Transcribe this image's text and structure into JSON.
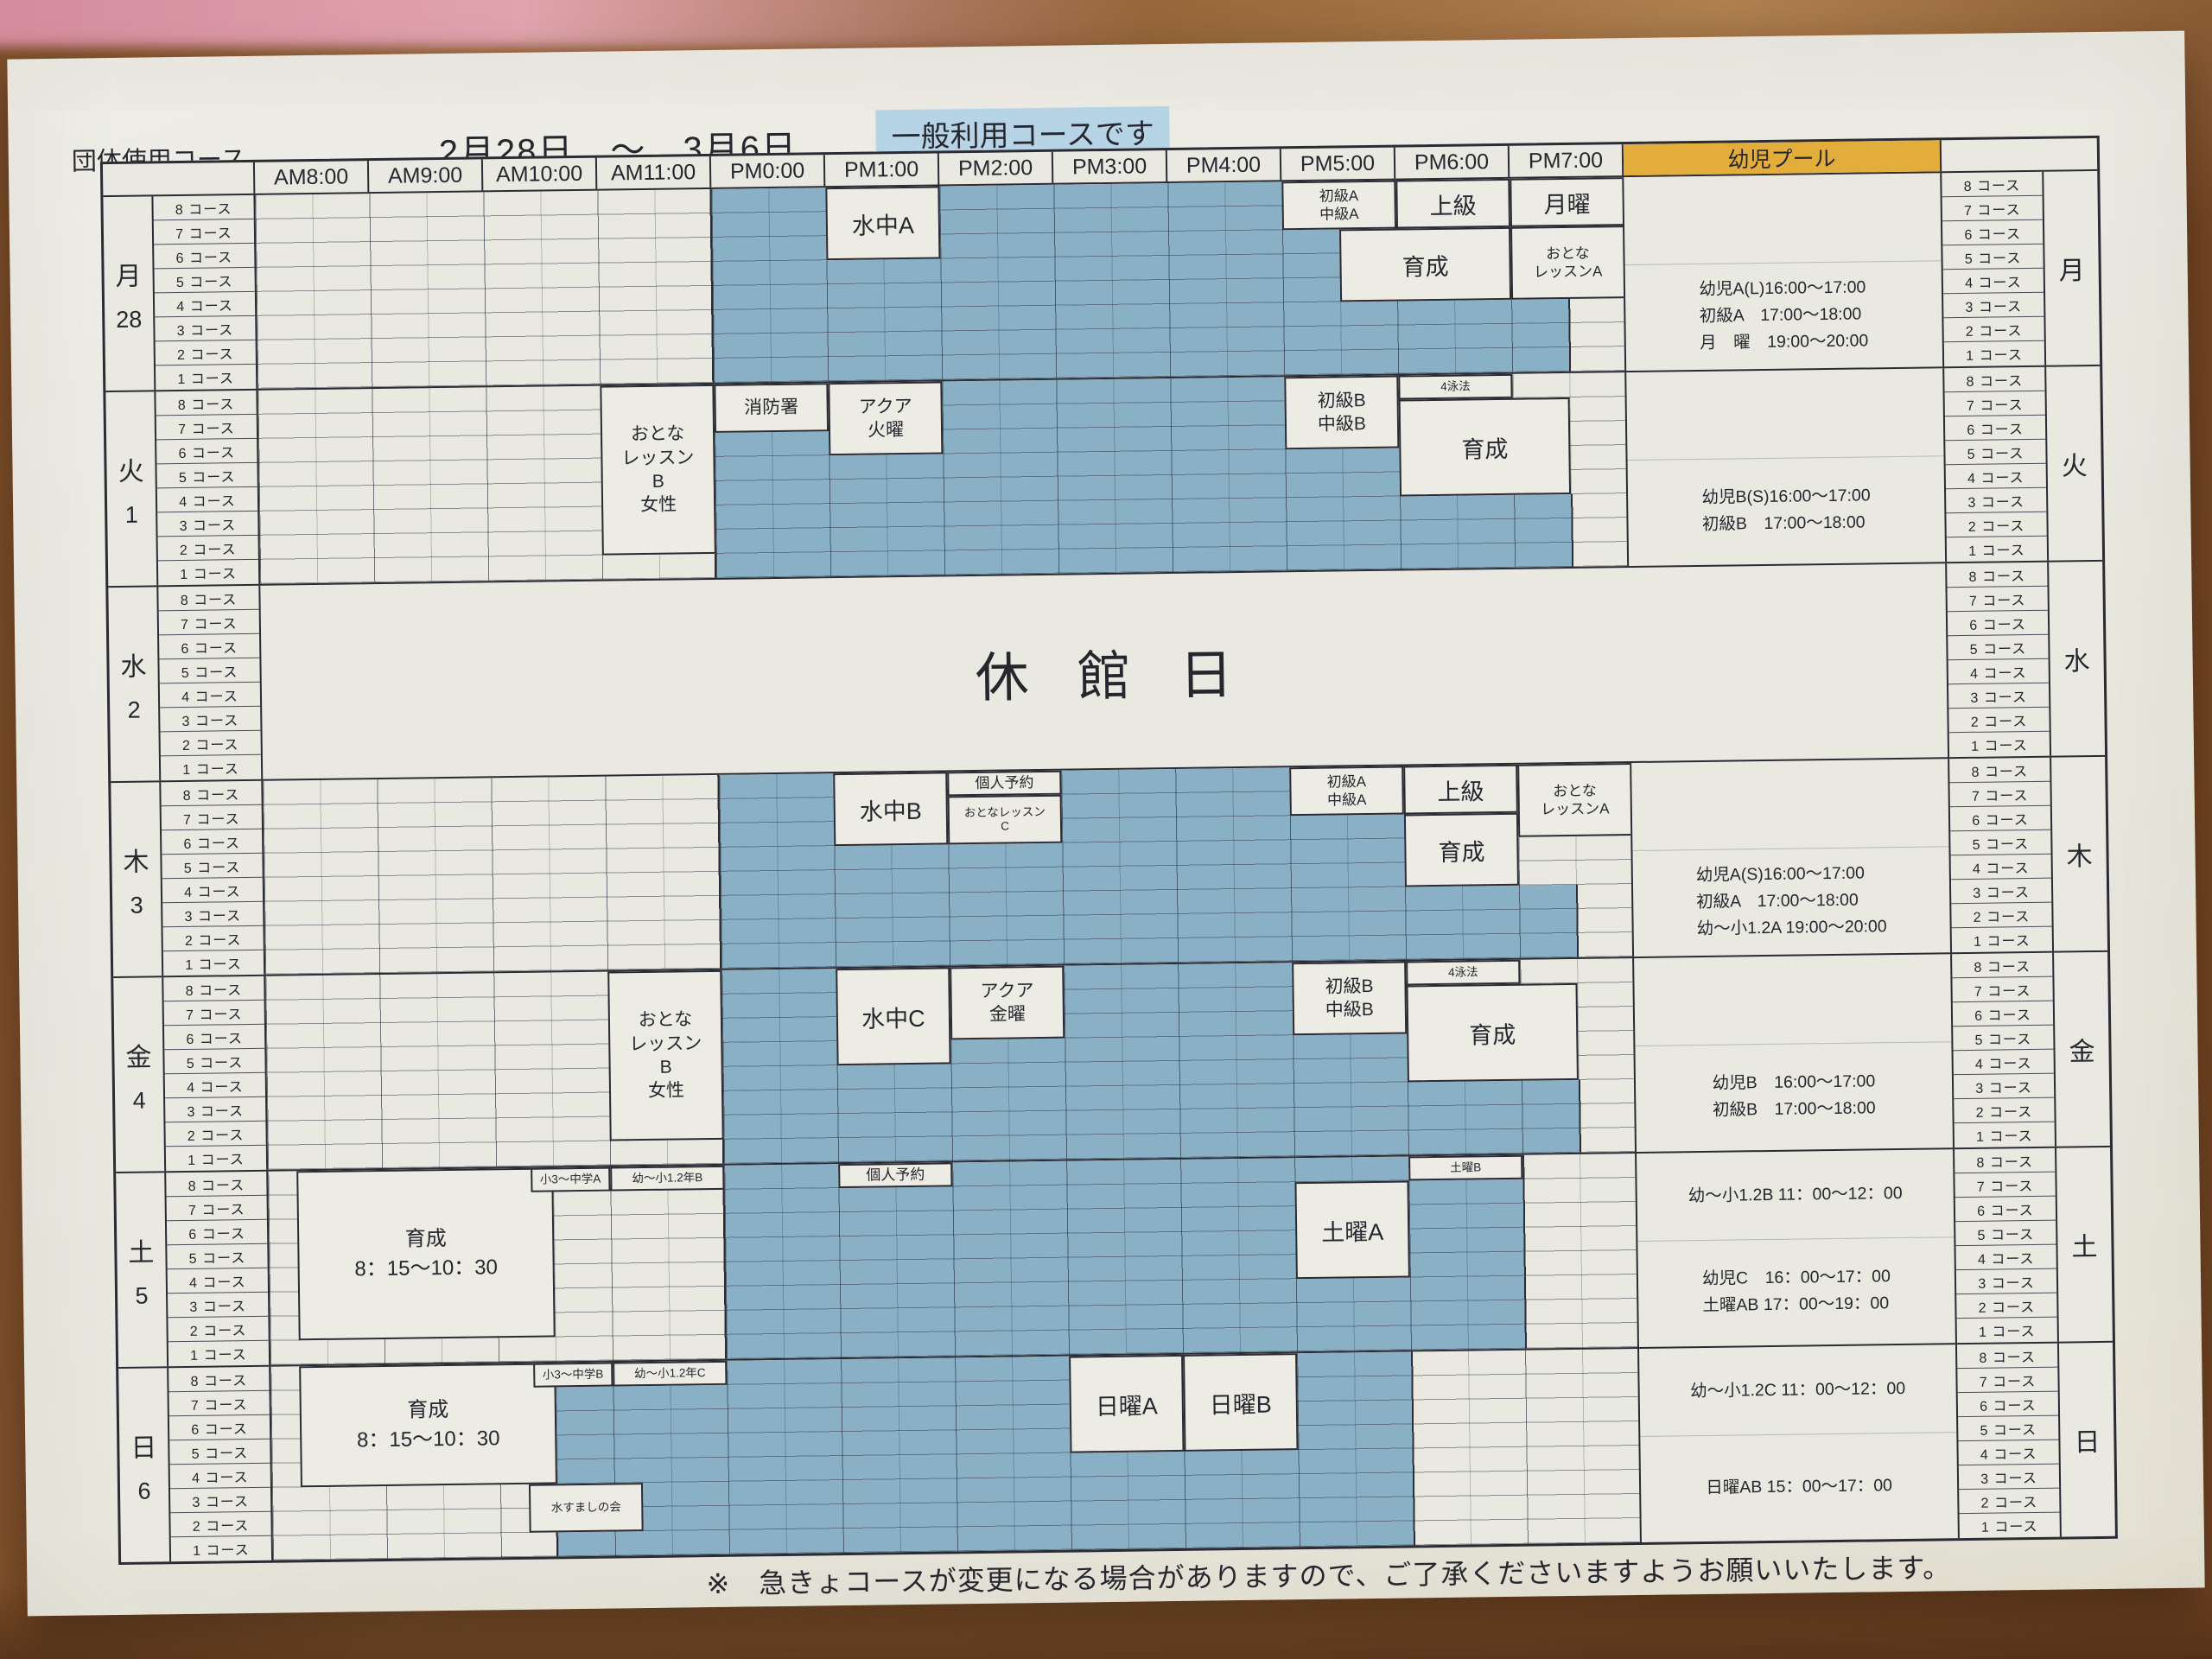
{
  "title": "団体使用コース",
  "date_range": "2月28日　～　3月6日",
  "highlight_note": "一般利用コースです",
  "footer_note": "※　急きょコースが変更になる場合がありますので、ご了承くださいますようお願いいたします。",
  "header": {
    "times": [
      "AM8:00",
      "AM9:00",
      "AM10:00",
      "AM11:00",
      "PM0:00",
      "PM1:00",
      "PM2:00",
      "PM3:00",
      "PM4:00",
      "PM5:00",
      "PM6:00",
      "PM7:00"
    ],
    "pool_label": "幼児プール"
  },
  "course_numbers": [
    8,
    7,
    6,
    5,
    4,
    3,
    2,
    1
  ],
  "course_unit": "コース",
  "colors": {
    "lane_blue": "#8ab0c6",
    "grid_line": "#2b2b33",
    "pool_header_bg": "#e3ad3c",
    "highlight_bg": "#b7d4e6",
    "paper": "#e9e8e0"
  },
  "days": [
    {
      "key": "mon",
      "day": "月",
      "date": "28",
      "closed": false,
      "lanes": [
        [
          8,
          18
        ],
        [
          8,
          18
        ],
        [
          8,
          19
        ],
        [
          8,
          19
        ],
        [
          8,
          19
        ],
        [
          8,
          23
        ],
        [
          8,
          23
        ],
        [
          8,
          23
        ]
      ],
      "blocks": [
        {
          "label": "水中A",
          "c": [
            10,
            12
          ],
          "r": [
            0,
            3
          ],
          "fs": "lg"
        },
        {
          "label": "初級A\n中級A",
          "c": [
            18,
            20
          ],
          "r": [
            0,
            2
          ],
          "fs": "sm"
        },
        {
          "label": "上級",
          "c": [
            20,
            22
          ],
          "r": [
            0,
            2
          ],
          "fs": "lg"
        },
        {
          "label": "月曜",
          "c": [
            22,
            24
          ],
          "r": [
            0,
            2
          ],
          "fs": "lg"
        },
        {
          "label": "育成",
          "c": [
            19,
            22
          ],
          "r": [
            2,
            5
          ],
          "fs": "lg"
        },
        {
          "label": "おとな\nレッスンA",
          "c": [
            22,
            24
          ],
          "r": [
            2,
            5
          ],
          "fs": "sm"
        }
      ],
      "pool_upper": [],
      "pool_lower": [
        "幼児A(L)16:00～17:00",
        "初級A　17:00～18:00",
        "月　曜　19:00～20:00"
      ]
    },
    {
      "key": "tue",
      "day": "火",
      "date": "1",
      "closed": false,
      "lanes": [
        [
          8,
          18
        ],
        [
          8,
          18
        ],
        [
          8,
          18
        ],
        [
          8,
          20
        ],
        [
          8,
          20
        ],
        [
          8,
          23
        ],
        [
          8,
          23
        ],
        [
          8,
          23
        ]
      ],
      "blocks": [
        {
          "label": "おとな\nレッスン\nB\n女性",
          "c": [
            6,
            8
          ],
          "r": [
            0,
            7
          ],
          "fs": "md"
        },
        {
          "label": "消防署",
          "c": [
            8,
            10
          ],
          "r": [
            0,
            2
          ],
          "fs": "md"
        },
        {
          "label": "アクア\n火曜",
          "c": [
            10,
            12
          ],
          "r": [
            0,
            3
          ],
          "fs": "md"
        },
        {
          "label": "初級B\n中級B",
          "c": [
            18,
            20
          ],
          "r": [
            0,
            3
          ],
          "fs": "md"
        },
        {
          "label": "4泳法",
          "c": [
            20,
            22
          ],
          "r": [
            0,
            1
          ],
          "fs": "xs"
        },
        {
          "label": "育成",
          "c": [
            20,
            23
          ],
          "r": [
            1,
            5
          ],
          "fs": "lg"
        }
      ],
      "pool_upper": [],
      "pool_lower": [
        "幼児B(S)16:00～17:00",
        "初級B　17:00～18:00"
      ]
    },
    {
      "key": "wed",
      "day": "水",
      "date": "2",
      "closed": true,
      "closed_label": "休館日",
      "lanes": [],
      "blocks": [],
      "pool_upper": [],
      "pool_lower": []
    },
    {
      "key": "thu",
      "day": "木",
      "date": "3",
      "closed": false,
      "lanes": [
        [
          8,
          18
        ],
        [
          8,
          18
        ],
        [
          8,
          20
        ],
        [
          8,
          20
        ],
        [
          8,
          20
        ],
        [
          8,
          23
        ],
        [
          8,
          23
        ],
        [
          8,
          23
        ]
      ],
      "blocks": [
        {
          "label": "水中B",
          "c": [
            10,
            12
          ],
          "r": [
            0,
            3
          ],
          "fs": "lg"
        },
        {
          "label": "個人予約",
          "c": [
            12,
            14
          ],
          "r": [
            0,
            1
          ],
          "fs": "sm"
        },
        {
          "label": "おとなレッスン\nC",
          "c": [
            12,
            14
          ],
          "r": [
            1,
            3
          ],
          "fs": "xs"
        },
        {
          "label": "初級A\n中級A",
          "c": [
            18,
            20
          ],
          "r": [
            0,
            2
          ],
          "fs": "sm"
        },
        {
          "label": "上級",
          "c": [
            20,
            22
          ],
          "r": [
            0,
            2
          ],
          "fs": "lg"
        },
        {
          "label": "おとな\nレッスンA",
          "c": [
            22,
            24
          ],
          "r": [
            0,
            3
          ],
          "fs": "sm"
        },
        {
          "label": "育成",
          "c": [
            20,
            22
          ],
          "r": [
            2,
            5
          ],
          "fs": "lg"
        }
      ],
      "pool_upper": [],
      "pool_lower": [
        "幼児A(S)16:00～17:00",
        "初級A　17:00～18:00",
        "幼～小1.2A 19:00～20:00"
      ]
    },
    {
      "key": "fri",
      "day": "金",
      "date": "4",
      "closed": false,
      "lanes": [
        [
          8,
          18
        ],
        [
          8,
          18
        ],
        [
          8,
          18
        ],
        [
          8,
          20
        ],
        [
          8,
          20
        ],
        [
          8,
          23
        ],
        [
          8,
          23
        ],
        [
          8,
          23
        ]
      ],
      "blocks": [
        {
          "label": "おとな\nレッスン\nB\n女性",
          "c": [
            6,
            8
          ],
          "r": [
            0,
            7
          ],
          "fs": "md"
        },
        {
          "label": "水中C",
          "c": [
            10,
            12
          ],
          "r": [
            0,
            4
          ],
          "fs": "lg"
        },
        {
          "label": "アクア\n金曜",
          "c": [
            12,
            14
          ],
          "r": [
            0,
            3
          ],
          "fs": "md"
        },
        {
          "label": "初級B\n中級B",
          "c": [
            18,
            20
          ],
          "r": [
            0,
            3
          ],
          "fs": "md"
        },
        {
          "label": "4泳法",
          "c": [
            20,
            22
          ],
          "r": [
            0,
            1
          ],
          "fs": "xs"
        },
        {
          "label": "育成",
          "c": [
            20,
            23
          ],
          "r": [
            1,
            5
          ],
          "fs": "lg"
        }
      ],
      "pool_upper": [],
      "pool_lower": [
        "幼児B　16:00～17:00",
        "初級B　17:00～18:00"
      ]
    },
    {
      "key": "sat",
      "day": "土",
      "date": "5",
      "closed": false,
      "lanes": [
        [
          8,
          22
        ],
        [
          8,
          22
        ],
        [
          8,
          22
        ],
        [
          8,
          22
        ],
        [
          8,
          22
        ],
        [
          8,
          22
        ],
        [
          8,
          22
        ],
        [
          8,
          22
        ]
      ],
      "blocks": [
        {
          "label": "育成\n8：15～10：30",
          "c": [
            0.5,
            5
          ],
          "r": [
            0,
            7
          ],
          "fs": "lg2"
        },
        {
          "label": "小3～中学A",
          "c": [
            4.6,
            6
          ],
          "r": [
            0,
            1
          ],
          "fs": "xs"
        },
        {
          "label": "幼～小1.2年B",
          "c": [
            6,
            8
          ],
          "r": [
            0,
            1
          ],
          "fs": "xs"
        },
        {
          "label": "個人予約",
          "c": [
            10,
            12
          ],
          "r": [
            0,
            1
          ],
          "fs": "sm"
        },
        {
          "label": "土曜A",
          "c": [
            18,
            20
          ],
          "r": [
            1,
            5
          ],
          "fs": "lg"
        },
        {
          "label": "土曜B",
          "c": [
            20,
            22
          ],
          "r": [
            0,
            1
          ],
          "fs": "xs"
        }
      ],
      "pool_upper": [
        "幼～小1.2B 11：00～12：00"
      ],
      "pool_lower": [
        "幼児C　16：00～17：00",
        "土曜AB 17：00～19：00"
      ]
    },
    {
      "key": "sun",
      "day": "日",
      "date": "6",
      "closed": false,
      "lanes": [
        [
          8,
          20
        ],
        [
          5,
          20
        ],
        [
          5,
          20
        ],
        [
          5,
          20
        ],
        [
          5,
          20
        ],
        [
          6.5,
          20
        ],
        [
          6.5,
          20
        ],
        [
          5,
          20
        ]
      ],
      "blocks": [
        {
          "label": "育成\n8：15～10：30",
          "c": [
            0.5,
            5
          ],
          "r": [
            0,
            5
          ],
          "fs": "lg2"
        },
        {
          "label": "小3～中学B",
          "c": [
            4.6,
            6
          ],
          "r": [
            0,
            1
          ],
          "fs": "xs"
        },
        {
          "label": "幼～小1.2年C",
          "c": [
            6,
            8
          ],
          "r": [
            0,
            1
          ],
          "fs": "xs"
        },
        {
          "label": "水すましの会",
          "c": [
            4.5,
            6.5
          ],
          "r": [
            5,
            7
          ],
          "fs": "xs"
        },
        {
          "label": "日曜A",
          "c": [
            14,
            16
          ],
          "r": [
            0,
            4
          ],
          "fs": "lg"
        },
        {
          "label": "日曜B",
          "c": [
            16,
            18
          ],
          "r": [
            0,
            4
          ],
          "fs": "lg"
        }
      ],
      "pool_upper": [
        "幼～小1.2C 11：00～12：00"
      ],
      "pool_lower": [
        "日曜AB 15：00～17：00"
      ]
    }
  ]
}
